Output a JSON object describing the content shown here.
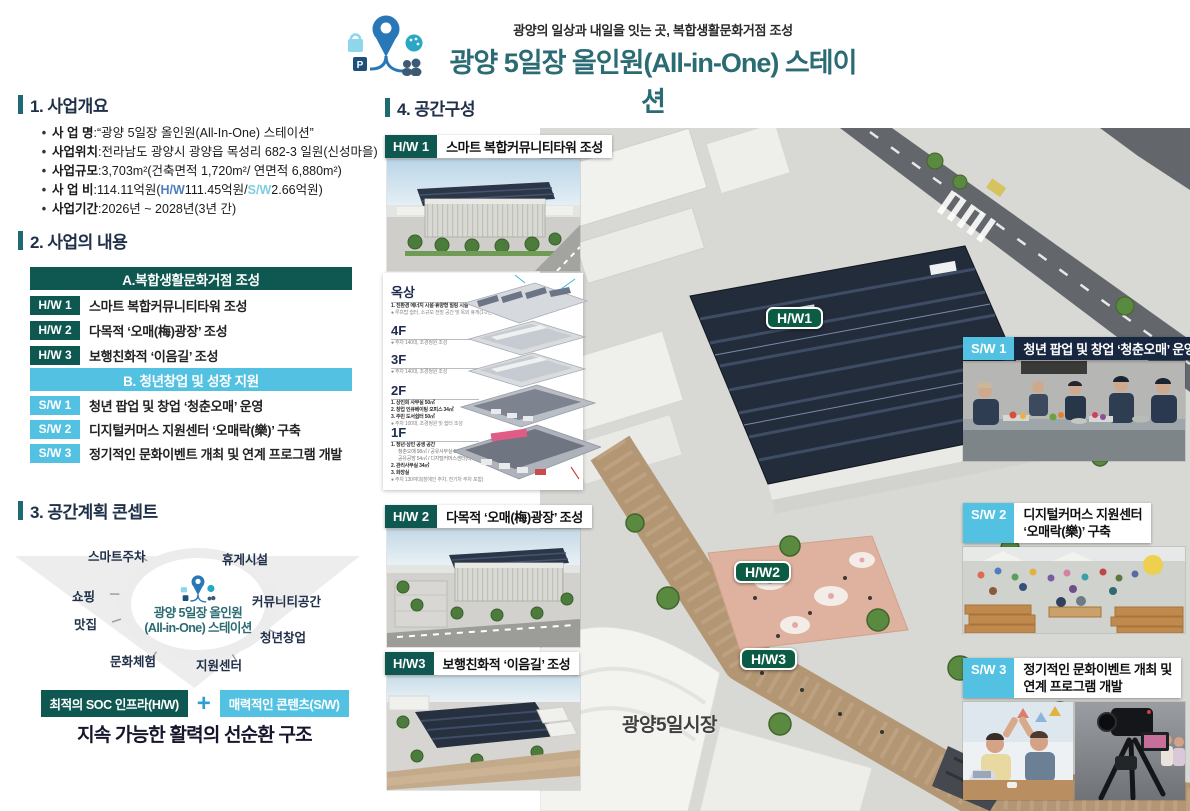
{
  "header": {
    "subtitle": "광양의 일상과 내일을 잇는 곳, 복합생활문화거점 조성",
    "title": "광양 5일장 올인원(All-in-One) 스테이션"
  },
  "logo": {
    "p": "P"
  },
  "bullet": "•",
  "sep": " : ",
  "section1": {
    "heading": "1. 사업개요",
    "name_label": "사 업 명",
    "name_value": "“광양 5일장 올인원(All-In-One) 스테이션”",
    "loc_label": "사업위치",
    "loc_value": "전라남도 광양시 광양읍 목성리 682-3 일원(신성마을)",
    "scale_label": "사업규모",
    "scale_value": "3,703m²(건축면적 1,720m²/ 연면적 6,880m²)",
    "budget_label": "사 업 비",
    "budget_pre": "114.11억원(",
    "budget_hw": "H/W",
    "budget_hw_amt": " 111.45억원/",
    "budget_sw": "S/W",
    "budget_sw_amt": " 2.66억원)",
    "period_label": "사업기간",
    "period_value": "2026년 ~ 2028년(3년 간)"
  },
  "section2": {
    "heading": "2. 사업의 내용",
    "group_a_header": "A.복합생활문화거점 조성",
    "hw_rows": [
      {
        "badge": "H/W 1",
        "text": "스마트 복합커뮤니티타워 조성"
      },
      {
        "badge": "H/W 2",
        "text": "다목적 ‘오매(梅)광장’ 조성"
      },
      {
        "badge": "H/W 3",
        "text": "보행친화적 ‘이음길’ 조성"
      }
    ],
    "group_b_header": "B. 청년창업 및 성장 지원",
    "sw_rows": [
      {
        "badge": "S/W 1",
        "text": "청년 팝업 및 창업 ‘청춘오매’ 운영"
      },
      {
        "badge": "S/W 2",
        "text": "디지털커머스 지원센터 ‘오매락(樂)’ 구축"
      },
      {
        "badge": "S/W 3",
        "text": "정기적인 문화이벤트 개최 및 연계 프로그램 개발"
      }
    ]
  },
  "section3": {
    "heading": "3. 공간계획 콘셉트",
    "hub_line1": "광양 5일장 올인원",
    "hub_line2": "(All-in-One) 스테이션",
    "spokes": [
      "스마트주차",
      "휴게시설",
      "쇼핑",
      "커뮤니티공간",
      "맛집",
      "청년창업",
      "문화체험",
      "지원센터"
    ],
    "formula_left": "최적의 SOC 인프라(H/W)",
    "formula_plus": "+",
    "formula_right": "매력적인 콘텐츠(S/W)",
    "conclusion": "지속 가능한 활력의 선순환 구조"
  },
  "section4": {
    "heading": "4. 공간구성",
    "hw1_badge": "H/W 1",
    "hw1_title": "스마트 복합커뮤니티타워 조성",
    "hw2_badge": "H/W 2",
    "hw2_title": "다목적 ‘오매(梅)광장’ 조성",
    "hw3_badge": "H/W3",
    "hw3_title": "보행친화적 ‘이음길’ 조성",
    "sw1_badge": "S/W 1",
    "sw1_title": "청년 팝업 및 창업 ‘청춘오매’ 운영",
    "sw2_badge": "S/W 2",
    "sw2_title_line1": "디지털커머스 지원센터",
    "sw2_title_line2": "‘오매락(樂)’ 구축",
    "sw3_badge": "S/W 3",
    "sw3_title_line1": "정기적인 문화이벤트 개최 및",
    "sw3_title_line2": "연계 프로그램 개발",
    "floors": [
      {
        "name": "옥상",
        "lines": [
          "1. 친환경 에너지 시설·휴양형 힐링 시설",
          "● 루프탑 쉼터, 소규모 전망 공간 및 옥외 휴게(1-2인 세팅)"
        ]
      },
      {
        "name": "4F",
        "lines": [
          "● 주차 140대, 조경정원 조성"
        ]
      },
      {
        "name": "3F",
        "lines": [
          "● 주차 140대, 조경정원 조성"
        ]
      },
      {
        "name": "2F",
        "lines": [
          "1. 상인회 사무실 50㎡",
          "2. 창업 인큐베이팅 오피스 34㎡",
          "3. 주민 도서쉼터 50㎡",
          "● 주차 100대, 조경정원 및 쉼터 조성"
        ]
      },
      {
        "name": "1F",
        "lines": [
          "1. 청년·상인 공생 공간",
          "청춘오매 98㎡ / 공유사무실 56㎡",
          "공유공방 54㎡ / 디지털커머스센터(라이브방송) 54㎡",
          "2. 관리사무실 34㎡",
          "3. 화장실",
          "● 주차 130여대(장애인 주차, 전기차 주차 포함)"
        ]
      }
    ],
    "aerial": {
      "badge1": "H/W1",
      "badge2": "H/W2",
      "badge3": "H/W3",
      "market_label": "광양5일시장"
    }
  },
  "colors": {
    "accent_teal": "#2b6b74",
    "hw_teal": "#0f5851",
    "sw_blue": "#53c2e2",
    "map_badge_green": "#0c5c44",
    "budget_hw_blue": "#4d7fc0",
    "budget_sw_blue": "#7ccfe3"
  }
}
